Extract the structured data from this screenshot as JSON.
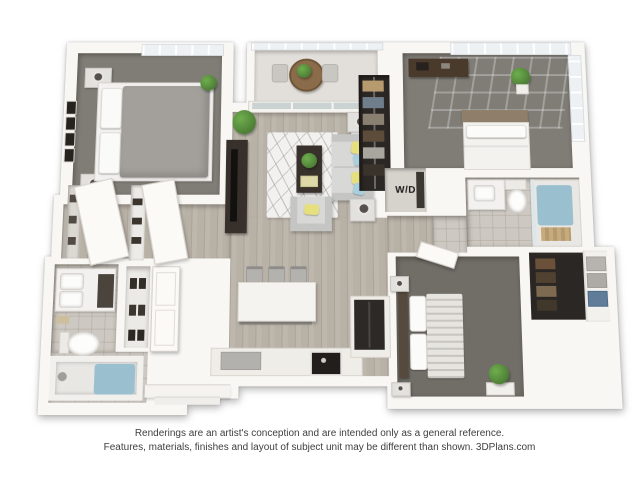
{
  "labels": {
    "washer_dryer": "W/D"
  },
  "disclaimer": {
    "line1": "Renderings are an artist's conception and are intended only as a general reference.",
    "line2": "Features, materials, finishes and layout of subject unit may be different than shown. 3DPlans.com"
  },
  "colors": {
    "wall": "#f8f7f4",
    "wall_line": "#d9d5cf",
    "carpet": "#807d77",
    "carpet_dark": "#716e68",
    "wood": "#b8b1a6",
    "tile": "#cdc8c1",
    "rug": "#f2f1f0",
    "sofa": "#d8d9d7",
    "sofa_shade": "#c5c6c4",
    "pillow_yellow": "#e6df7d",
    "pillow_blue": "#a9cede",
    "dark_wood": "#38312b",
    "plant": "#4e8038",
    "water": "#9abfce",
    "tan_headboard": "#8f7e6a",
    "glass": "#edf1f3",
    "counter": "#efede8",
    "basket_blue": "#5f7d99",
    "closet_dark": "#2b2724",
    "text": "#3e3e3e"
  }
}
